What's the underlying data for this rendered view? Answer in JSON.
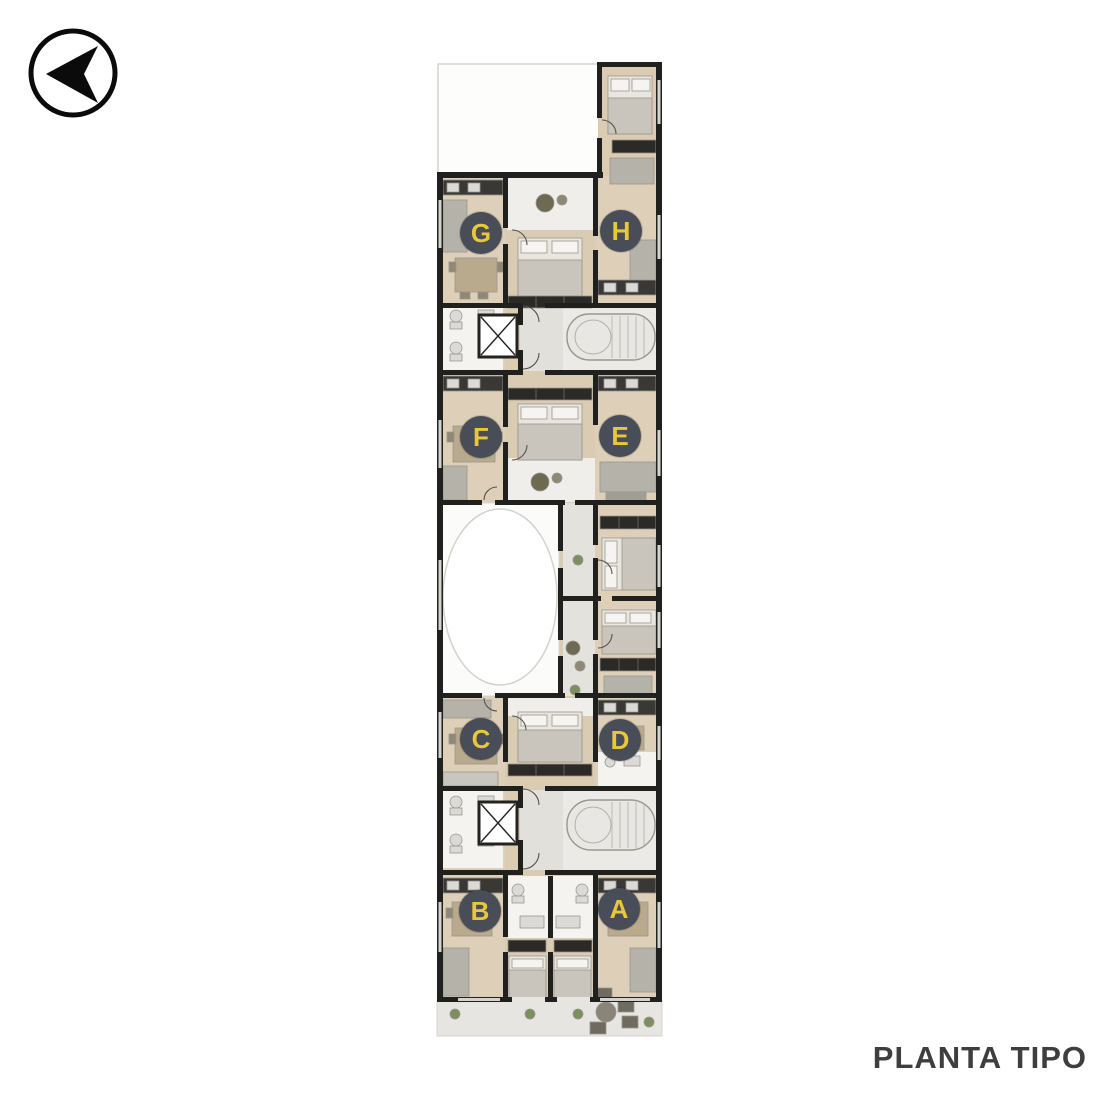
{
  "title": {
    "text": "PLANTA TIPO",
    "color": "#3e3e3e"
  },
  "compass": {
    "name": "north-arrow",
    "pointing": "left",
    "color": "#0b0b0b"
  },
  "plan": {
    "name": "typical-floor-plan",
    "units": [
      {
        "letter": "G"
      },
      {
        "letter": "H"
      },
      {
        "letter": "F"
      },
      {
        "letter": "E"
      },
      {
        "letter": "C"
      },
      {
        "letter": "D"
      },
      {
        "letter": "B"
      },
      {
        "letter": "A"
      }
    ],
    "badge": {
      "background": "#484d57",
      "text_color": "#e9c73d"
    },
    "colors": {
      "wall": "#20201e",
      "wood_floor": "#dbcbb2",
      "white_room": "#f6f5f2",
      "terrace_gray": "#e7e5e1",
      "corridor_gray": "#e2e0db",
      "plan_outline": "#d6d4d0",
      "wardrobe_dark": "#2b2a27",
      "plant_green": "#7c8f5f"
    },
    "features": [
      "elevator",
      "stairs",
      "oval-patio",
      "balcony",
      "bedrooms",
      "bathrooms",
      "kitchens"
    ]
  }
}
